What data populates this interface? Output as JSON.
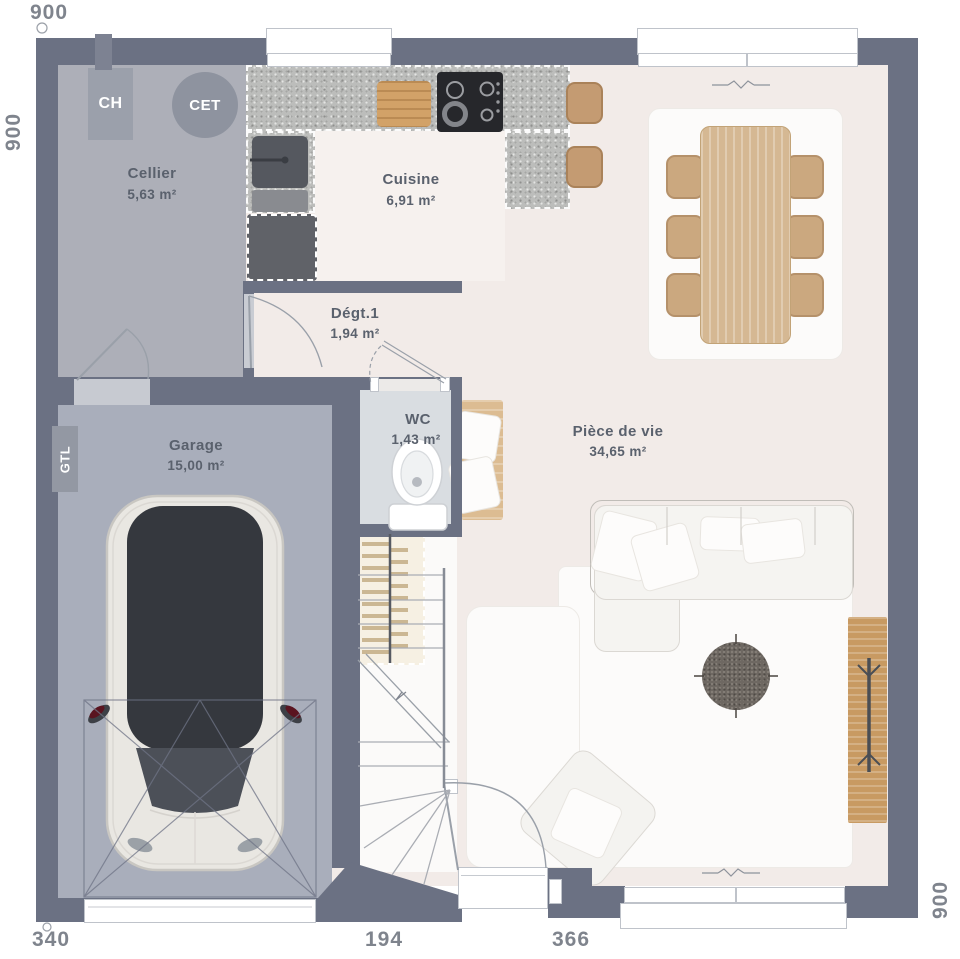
{
  "plan": {
    "rooms": {
      "cellier": {
        "name": "Cellier",
        "area": "5,63 m²"
      },
      "cuisine": {
        "name": "Cuisine",
        "area": "6,91 m²"
      },
      "degt1": {
        "name": "Dégt.1",
        "area": "1,94 m²"
      },
      "garage": {
        "name": "Garage",
        "area": "15,00 m²"
      },
      "wc": {
        "name": "WC",
        "area": "1,43 m²"
      },
      "piece_de_vie": {
        "name": "Pièce de vie",
        "area": "34,65 m²"
      }
    },
    "equipment": {
      "boiler_label": "CH",
      "water_heater_label": "CET",
      "gtl_label": "GTL"
    },
    "dimensions": {
      "top_width": "900",
      "left_height": "900",
      "right_height": "900",
      "bottom_garage_width": "340",
      "bottom_entrance_width": "194",
      "bottom_living_width": "366"
    },
    "colors": {
      "wall": "#6b7183",
      "floor_living": "#f2ebe8",
      "floor_cellier": "#adafb8",
      "floor_garage": "#a9aebb",
      "floor_wc": "#d9dde1",
      "counter_granite": "#bcbdbb",
      "wood": "#cfae85"
    }
  }
}
